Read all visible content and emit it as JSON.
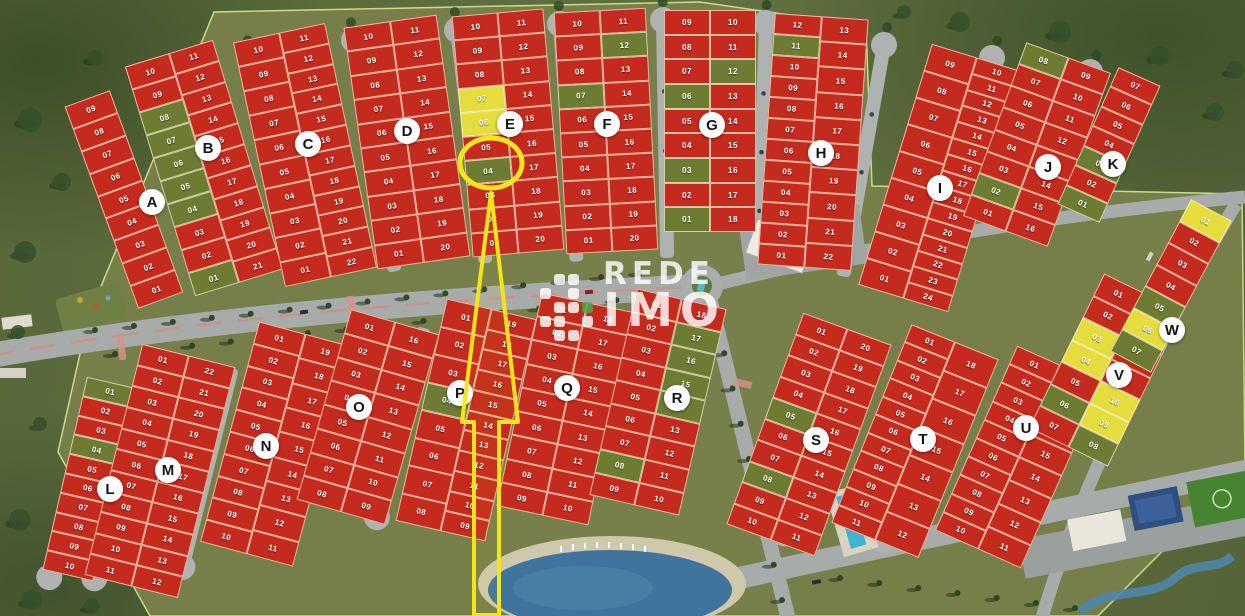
{
  "watermark": {
    "line1": "REDE",
    "line2": "IMO"
  },
  "highlight": {
    "block": "E",
    "lot": "04"
  },
  "colors": {
    "lot_red": "#c42a1e",
    "lot_green": "#6d7b33",
    "lot_yellow": "#e5dd3e",
    "highlight": "#f4e41a",
    "road": "#a7acaa"
  },
  "blocks": [
    {
      "label": "A",
      "columns": [
        [
          "09",
          "08",
          "07",
          "06",
          "05",
          "04",
          "03",
          "02",
          "01"
        ]
      ],
      "green": [],
      "yellow": []
    },
    {
      "label": "B",
      "columns": [
        [
          "10",
          "09",
          "08",
          "07",
          "06",
          "05",
          "04",
          "03",
          "02",
          "01"
        ],
        [
          "11",
          "12",
          "13",
          "14",
          "15",
          "16",
          "17",
          "18",
          "19",
          "20",
          "21"
        ]
      ],
      "green": [
        "08",
        "07",
        "06",
        "05",
        "04",
        "01"
      ],
      "yellow": []
    },
    {
      "label": "C",
      "columns": [
        [
          "10",
          "09",
          "08",
          "07",
          "06",
          "05",
          "04",
          "03",
          "02",
          "01"
        ],
        [
          "11",
          "12",
          "13",
          "14",
          "15",
          "16",
          "17",
          "18",
          "19",
          "20",
          "21",
          "22"
        ]
      ],
      "green": [],
      "yellow": []
    },
    {
      "label": "D",
      "columns": [
        [
          "10",
          "09",
          "08",
          "07",
          "06",
          "05",
          "04",
          "03",
          "02",
          "01"
        ],
        [
          "11",
          "12",
          "13",
          "14",
          "15",
          "16",
          "17",
          "18",
          "19",
          "20"
        ]
      ],
      "green": [],
      "yellow": []
    },
    {
      "label": "E",
      "columns": [
        [
          "10",
          "09",
          "08",
          "07",
          "06",
          "05",
          "04",
          "03",
          "02",
          "01"
        ],
        [
          "11",
          "12",
          "13",
          "14",
          "15",
          "16",
          "17",
          "18",
          "19",
          "20"
        ]
      ],
      "green": [
        "04"
      ],
      "yellow": [
        "07",
        "06"
      ]
    },
    {
      "label": "F",
      "columns": [
        [
          "10",
          "09",
          "08",
          "07",
          "06",
          "05",
          "04",
          "03",
          "02",
          "01"
        ],
        [
          "11",
          "12",
          "13",
          "14",
          "15",
          "16",
          "17",
          "18",
          "19",
          "20"
        ]
      ],
      "green": [
        "07",
        "12"
      ],
      "yellow": []
    },
    {
      "label": "G",
      "columns": [
        [
          "09",
          "08",
          "07",
          "06",
          "05",
          "04",
          "03",
          "02",
          "01"
        ],
        [
          "10",
          "11",
          "12",
          "13",
          "14",
          "15",
          "16",
          "17",
          "18"
        ]
      ],
      "green": [
        "06",
        "03",
        "01",
        "12"
      ],
      "yellow": []
    },
    {
      "label": "H",
      "columns": [
        [
          "12",
          "11",
          "10",
          "09",
          "08",
          "07",
          "06",
          "05",
          "04",
          "03",
          "02",
          "01"
        ],
        [
          "13",
          "14",
          "15",
          "16",
          "17",
          "18",
          "19",
          "20",
          "21",
          "22"
        ]
      ],
      "green": [
        "11"
      ],
      "yellow": []
    },
    {
      "label": "I",
      "columns": [
        [
          "09",
          "08",
          "07",
          "06",
          "05",
          "04",
          "03",
          "02",
          "01"
        ],
        [
          "10",
          "11",
          "12",
          "13",
          "14",
          "15",
          "16",
          "17",
          "18",
          "19",
          "20",
          "21",
          "22",
          "23",
          "24"
        ]
      ],
      "green": [],
      "yellow": []
    },
    {
      "label": "J",
      "columns": [
        [
          "08",
          "07",
          "06",
          "05",
          "04",
          "03",
          "02",
          "01"
        ],
        [
          "09",
          "10",
          "11",
          "12",
          "13",
          "14",
          "15",
          "16"
        ]
      ],
      "green": [
        "08",
        "02"
      ],
      "yellow": []
    },
    {
      "label": "K",
      "columns": [
        [
          "07",
          "06",
          "05",
          "04",
          "03",
          "02",
          "01"
        ]
      ],
      "green": [
        "03",
        "01"
      ],
      "yellow": []
    },
    {
      "label": "L",
      "columns": [
        [
          "01",
          "02",
          "03",
          "04",
          "05",
          "06",
          "07",
          "08",
          "09",
          "10"
        ]
      ],
      "green": [
        "01",
        "04"
      ],
      "yellow": []
    },
    {
      "label": "M",
      "columns": [
        [
          "01",
          "02",
          "03",
          "04",
          "05",
          "06",
          "07",
          "08",
          "09",
          "10",
          "11"
        ],
        [
          "22",
          "21",
          "20",
          "19",
          "18",
          "17",
          "16",
          "15",
          "14",
          "13",
          "12"
        ]
      ],
      "green": [],
      "yellow": []
    },
    {
      "label": "N",
      "columns": [
        [
          "01",
          "02",
          "03",
          "04",
          "05",
          "06",
          "07",
          "08",
          "09",
          "10"
        ],
        [
          "19",
          "18",
          "17",
          "16",
          "15",
          "14",
          "13",
          "12",
          "11"
        ]
      ],
      "green": [],
      "yellow": []
    },
    {
      "label": "O",
      "columns": [
        [
          "01",
          "02",
          "03",
          "04",
          "05",
          "06",
          "07",
          "08"
        ],
        [
          "16",
          "15",
          "14",
          "13",
          "12",
          "11",
          "10",
          "09"
        ]
      ],
      "green": [],
      "yellow": []
    },
    {
      "label": "P",
      "columns": [
        [
          "01",
          "02",
          "03",
          "04",
          "05",
          "06",
          "07",
          "08"
        ],
        [
          "19",
          "18",
          "17",
          "16",
          "15",
          "14",
          "13",
          "12",
          "11",
          "10",
          "09"
        ]
      ],
      "green": [
        "04"
      ],
      "yellow": []
    },
    {
      "label": "Q",
      "columns": [
        [
          "01",
          "02",
          "03",
          "04",
          "05",
          "06",
          "07",
          "08",
          "09"
        ],
        [
          "18",
          "17",
          "16",
          "15",
          "14",
          "13",
          "12",
          "11",
          "10"
        ]
      ],
      "green": [],
      "yellow": []
    },
    {
      "label": "R",
      "columns": [
        [
          "01",
          "02",
          "03",
          "04",
          "05",
          "06",
          "07",
          "08",
          "09"
        ],
        [
          "18",
          "17",
          "16",
          "15",
          "14",
          "13",
          "12",
          "11",
          "10"
        ]
      ],
      "green": [
        "08",
        "17",
        "16",
        "15",
        "14"
      ],
      "yellow": []
    },
    {
      "label": "S",
      "columns": [
        [
          "01",
          "02",
          "03",
          "04",
          "05",
          "06",
          "07",
          "08",
          "09",
          "10"
        ],
        [
          "20",
          "19",
          "18",
          "17",
          "16",
          "15",
          "14",
          "13",
          "12",
          "11"
        ]
      ],
      "green": [
        "05",
        "08"
      ],
      "yellow": []
    },
    {
      "label": "T",
      "columns": [
        [
          "01",
          "02",
          "03",
          "04",
          "05",
          "06",
          "07",
          "08",
          "09",
          "10",
          "11"
        ],
        [
          "18",
          "17",
          "16",
          "15",
          "14",
          "13",
          "12"
        ]
      ],
      "green": [],
      "yellow": []
    },
    {
      "label": "U",
      "columns": [
        [
          "01",
          "02",
          "03",
          "04",
          "05",
          "06",
          "07",
          "08",
          "09",
          "10"
        ],
        [
          "18",
          "17",
          "16",
          "15",
          "14",
          "13",
          "12",
          "11"
        ]
      ],
      "green": [],
      "yellow": []
    },
    {
      "label": "V",
      "columns": [
        [
          "01",
          "02",
          "03",
          "04",
          "05",
          "06",
          "07"
        ],
        [
          "14",
          "13",
          "12",
          "11",
          "10",
          "09",
          "08"
        ]
      ],
      "green": [
        "13",
        "06",
        "08"
      ],
      "yellow": [
        "03",
        "04",
        "10",
        "09"
      ]
    },
    {
      "label": "W",
      "columns": [
        [
          "01",
          "02",
          "03",
          "04",
          "05",
          "06",
          "07"
        ]
      ],
      "green": [
        "05",
        "07"
      ],
      "yellow": [
        "01",
        "06"
      ]
    }
  ]
}
